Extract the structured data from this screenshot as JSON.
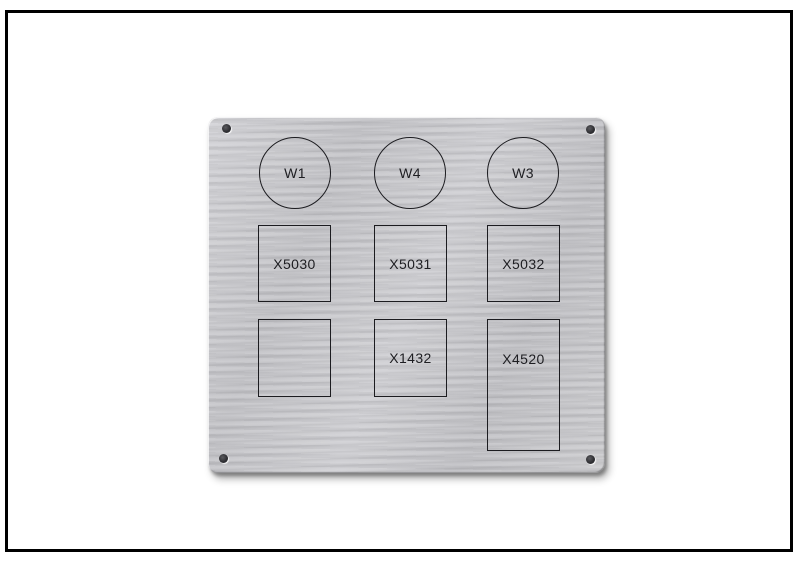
{
  "scene": {
    "background_color": "#ffffff",
    "frame_color": "#000000"
  },
  "plate": {
    "color": "#c9c9cd",
    "line_color": "#1c1c20",
    "text_color": "#1e1e22",
    "circles": [
      {
        "label": "W1"
      },
      {
        "label": "W4"
      },
      {
        "label": "W3"
      }
    ],
    "cutouts_row2": [
      {
        "label": "X5030"
      },
      {
        "label": "X5031"
      },
      {
        "label": "X5032"
      }
    ],
    "cutouts_row3": [
      {
        "label": ""
      },
      {
        "label": "X1432"
      },
      {
        "label": "X4520"
      }
    ]
  }
}
